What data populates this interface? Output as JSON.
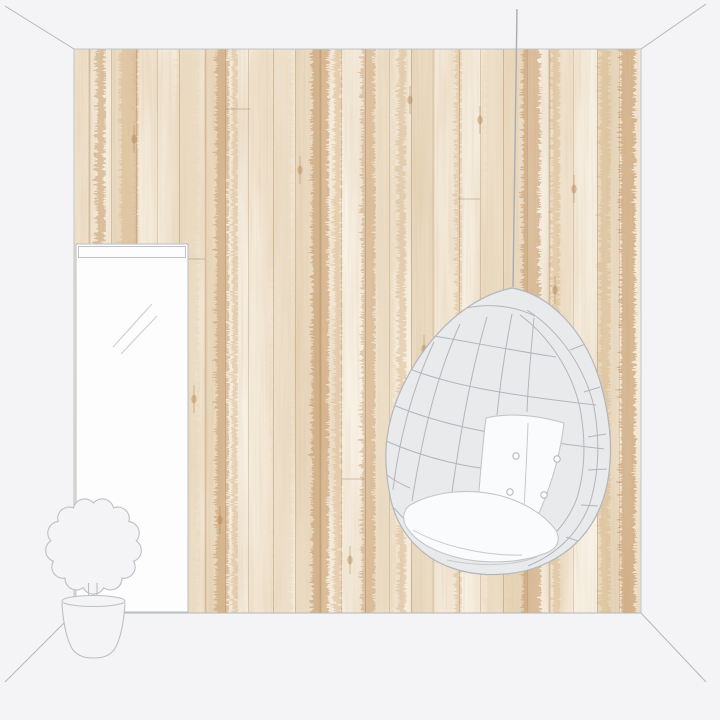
{
  "meta": {
    "description": "Room mockup: whitewashed wood plank wallpaper wall in a sketched interior with leaning mirror, potted plant and hanging egg chair",
    "visible_text": []
  },
  "palette": {
    "backdrop": "#f4f4f6",
    "outline": "#b3b6ba",
    "wall_edge": "#c2c4c7",
    "furniture_fill": "#f4f4f6",
    "furniture_line": "#bcbfc3",
    "mirror_fill": "#fdfdfe",
    "mirror_line": "#c0c3c6",
    "mirror_reflection": "#cdd0d3",
    "chair_fill": "#e9eaec",
    "chair_line": "#b2b6ba",
    "chair_line_soft": "#c7cacd",
    "cushion_fill": "#fafbfc",
    "cushion_line": "#c3c6c9",
    "cord": "#a9adb1",
    "wood_base": "#f4ebdb",
    "wood_light": "#f8f2e6",
    "wood_mid": "#e9d9bf",
    "wood_tan": "#d9b98e",
    "wood_brown": "#c0905c",
    "wood_dark": "#a97a45",
    "gap_line": "rgba(160,120,72,0.35)"
  },
  "wall": {
    "x": 74,
    "y": 49,
    "width": 567,
    "height": 564
  },
  "wallpaper": {
    "plank_boundaries": [
      15,
      37,
      62,
      83,
      105,
      131,
      151,
      174,
      199,
      221,
      246,
      267,
      291,
      315,
      337,
      359,
      385,
      406,
      429,
      453,
      475,
      499,
      523,
      545
    ],
    "plank_tones": [
      1,
      0,
      2,
      1,
      0,
      1,
      2,
      0,
      1,
      0,
      2,
      1,
      0,
      1,
      0,
      2,
      1,
      0,
      1,
      2,
      0,
      1,
      0,
      2,
      1
    ],
    "streaks": [
      {
        "x": 20,
        "w": 9,
        "c": "wood_brown",
        "o": 0.45
      },
      {
        "x": 44,
        "w": 14,
        "c": "wood_tan",
        "o": 0.55
      },
      {
        "x": 58,
        "w": 5,
        "c": "wood_brown",
        "o": 0.35
      },
      {
        "x": 140,
        "w": 12,
        "c": "wood_brown",
        "o": 0.45
      },
      {
        "x": 156,
        "w": 6,
        "c": "wood_tan",
        "o": 0.5
      },
      {
        "x": 236,
        "w": 16,
        "c": "wood_brown",
        "o": 0.5
      },
      {
        "x": 258,
        "w": 8,
        "c": "wood_tan",
        "o": 0.5
      },
      {
        "x": 286,
        "w": 12,
        "c": "wood_brown",
        "o": 0.4
      },
      {
        "x": 322,
        "w": 8,
        "c": "wood_tan",
        "o": 0.5
      },
      {
        "x": 380,
        "w": 6,
        "c": "wood_tan",
        "o": 0.45
      },
      {
        "x": 446,
        "w": 18,
        "c": "wood_brown",
        "o": 0.5
      },
      {
        "x": 476,
        "w": 8,
        "c": "wood_tan",
        "o": 0.5
      },
      {
        "x": 524,
        "w": 10,
        "c": "wood_tan",
        "o": 0.5
      },
      {
        "x": 544,
        "w": 15,
        "c": "wood_brown",
        "o": 0.55
      },
      {
        "x": 100,
        "w": 22,
        "c": "wood_mid",
        "o": 0.6
      },
      {
        "x": 196,
        "w": 20,
        "c": "wood_mid",
        "o": 0.5
      },
      {
        "x": 300,
        "w": 18,
        "c": "wood_mid",
        "o": 0.55
      },
      {
        "x": 410,
        "w": 24,
        "c": "wood_mid",
        "o": 0.5
      }
    ],
    "washes": [
      {
        "x": 84,
        "w": 44,
        "o": 0.14
      },
      {
        "x": 188,
        "w": 36,
        "o": 0.12
      },
      {
        "x": 294,
        "w": 30,
        "o": 0.16
      },
      {
        "x": 402,
        "w": 40,
        "o": 0.12
      },
      {
        "x": 470,
        "w": 26,
        "o": 0.12
      },
      {
        "x": 10,
        "w": 30,
        "o": 0.1
      }
    ],
    "knots": [
      {
        "x": 226,
        "y": 121
      },
      {
        "x": 336,
        "y": 51
      },
      {
        "x": 481,
        "y": 241
      },
      {
        "x": 146,
        "y": 471
      },
      {
        "x": 406,
        "y": 71
      },
      {
        "x": 56,
        "y": 251
      },
      {
        "x": 516,
        "y": 431
      },
      {
        "x": 276,
        "y": 511
      },
      {
        "x": 120,
        "y": 350
      },
      {
        "x": 350,
        "y": 300
      },
      {
        "x": 500,
        "y": 140
      },
      {
        "x": 60,
        "y": 90
      }
    ],
    "joints": [
      {
        "x1": 105,
        "x2": 131,
        "y": 210
      },
      {
        "x1": 268,
        "x2": 291,
        "y": 430
      },
      {
        "x1": 384,
        "x2": 406,
        "y": 150
      },
      {
        "x1": 499,
        "x2": 523,
        "y": 330
      },
      {
        "x1": 152,
        "x2": 176,
        "y": 60
      },
      {
        "x1": 429,
        "x2": 453,
        "y": 500
      }
    ]
  },
  "plant": {
    "foliage": {
      "cx": 93.5,
      "cy": 546,
      "r": 43,
      "bumps": 13
    }
  },
  "chair": {
    "buttons": [
      {
        "x": 516,
        "y": 456
      },
      {
        "x": 557,
        "y": 459
      },
      {
        "x": 510,
        "y": 492
      },
      {
        "x": 544,
        "y": 495
      }
    ]
  }
}
